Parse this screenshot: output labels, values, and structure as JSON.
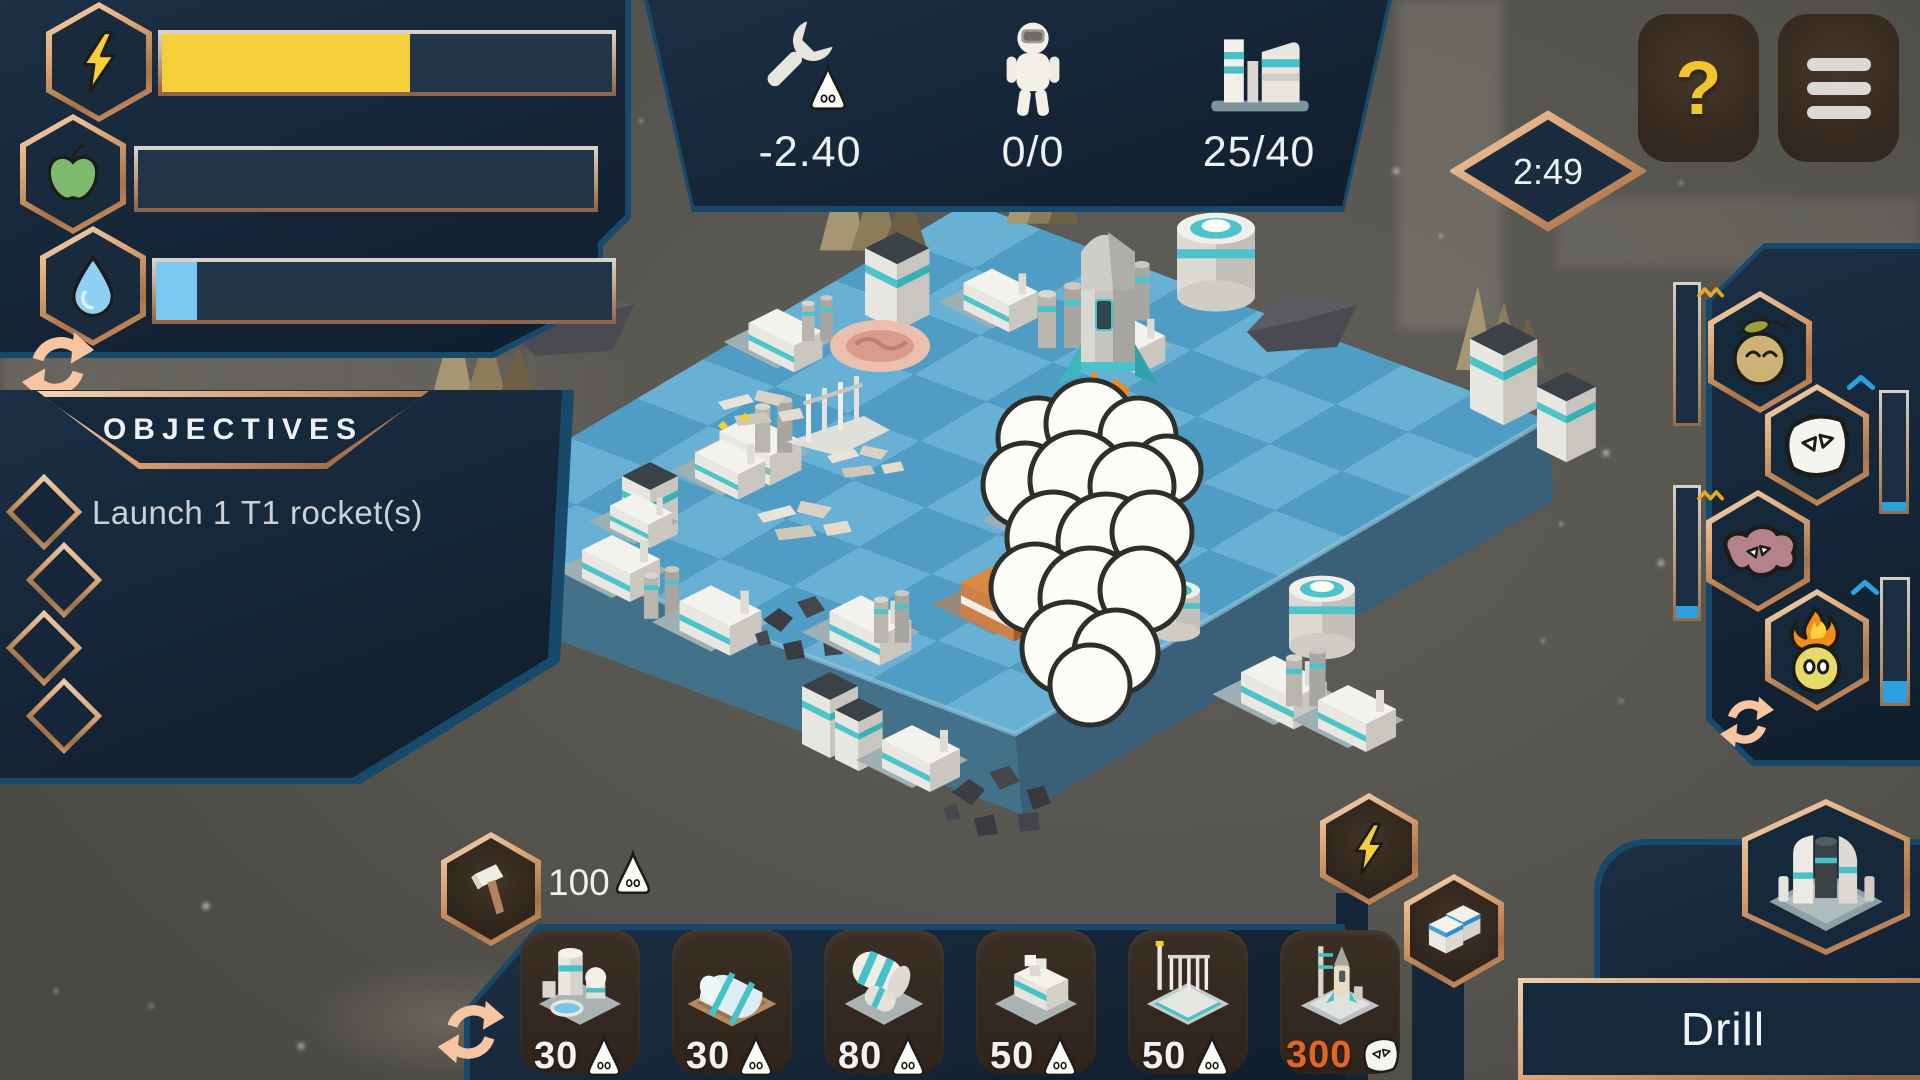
{
  "resource_panel": {
    "bars": [
      {
        "name": "energy",
        "fill": "55%",
        "color": "#f4cf3a"
      },
      {
        "name": "food",
        "fill": "0%",
        "color": "#7fb96d"
      },
      {
        "name": "water",
        "fill": "9%",
        "color": "#7dc8f1"
      }
    ]
  },
  "top_stats": {
    "maintenance_rate": "-2.40",
    "astronauts": "0/0",
    "buildings_used": "25/40"
  },
  "timer": {
    "value": "2:49"
  },
  "header": {
    "help_label": "?"
  },
  "objectives": {
    "title": "OBJECTIVES",
    "items": [
      {
        "label": "Launch 1 T1 rocket(s)"
      },
      {
        "label": ""
      },
      {
        "label": ""
      },
      {
        "label": ""
      }
    ]
  },
  "creatures": {
    "items": [
      {
        "name": "sprout",
        "bar_fill": "0%"
      },
      {
        "name": "mask",
        "bar_fill": "8%"
      },
      {
        "name": "blob",
        "bar_fill": "9%"
      },
      {
        "name": "flame",
        "bar_fill": "18%"
      }
    ]
  },
  "build_toolbar": {
    "resource_count": "100",
    "cards": [
      {
        "name": "extractor",
        "cost": "30",
        "cost_color": "#f1f2f3"
      },
      {
        "name": "greenhouse",
        "cost": "30",
        "cost_color": "#f1f2f3"
      },
      {
        "name": "storage",
        "cost": "80",
        "cost_color": "#f1f2f3"
      },
      {
        "name": "factory",
        "cost": "50",
        "cost_color": "#f1f2f3"
      },
      {
        "name": "launch-tower",
        "cost": "50",
        "cost_color": "#f1f2f3"
      },
      {
        "name": "rocket-pad",
        "cost": "300",
        "cost_color": "#e2662a"
      }
    ]
  },
  "selection": {
    "label": "Drill"
  },
  "colors": {
    "copper": "#d99e6f",
    "panel_navy": "#16293c",
    "accent_blue": "#17496a",
    "meter_blue": "#2ba2df"
  }
}
